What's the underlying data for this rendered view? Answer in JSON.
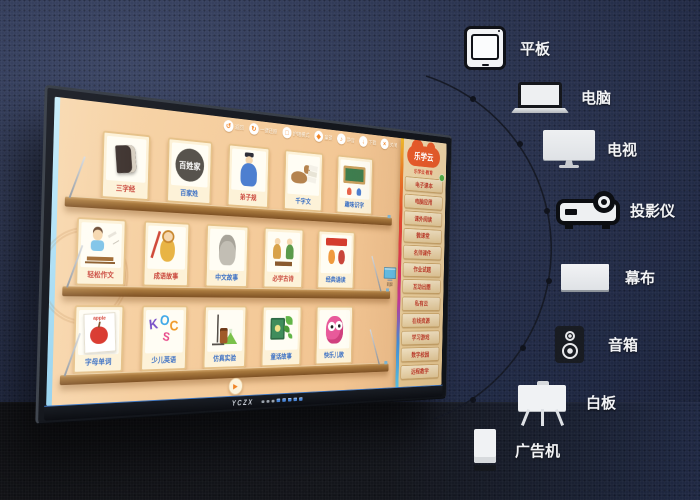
{
  "palette": {
    "background_navy": "#2b3450",
    "floor_dark": "#131419",
    "screen_peach": "#f5cd9f",
    "shelf_wood": "#9c6a33",
    "accent_orange": "#f08426",
    "logo_red": "#ee5a2a",
    "menu_text_red": "#c0392b",
    "device_label_white": "#f2f3f5"
  },
  "devices": [
    {
      "id": "tablet",
      "label": "平板"
    },
    {
      "id": "computer",
      "label": "电脑"
    },
    {
      "id": "tv",
      "label": "电视"
    },
    {
      "id": "projector",
      "label": "投影仪"
    },
    {
      "id": "projection-screen",
      "label": "幕布"
    },
    {
      "id": "speaker",
      "label": "音箱"
    },
    {
      "id": "whiteboard",
      "label": "白板"
    },
    {
      "id": "ad-kiosk",
      "label": "广告机"
    }
  ],
  "board": {
    "brand": "YCZX",
    "play_char": "▶",
    "seal_text": "百姓家",
    "letters": "KOCS",
    "apple_word": "apple",
    "mini_display_label": "同屏",
    "toolbar": [
      {
        "char": "↺",
        "label": "返回"
      },
      {
        "char": "↻",
        "label": "一键还原"
      },
      {
        "char": "□",
        "label": "护眼模式"
      },
      {
        "char": "◆",
        "label": "童锁"
      },
      {
        "char": "♪",
        "label": "静音"
      },
      {
        "char": "↓",
        "label": "下载"
      },
      {
        "char": "×",
        "label": "关闭"
      }
    ],
    "shelves": [
      {
        "cards": [
          {
            "label": "三字经",
            "label_style": "color:#c9453a"
          },
          {
            "label": "百家姓",
            "label_style": "color:#3a6fc4"
          },
          {
            "label": "弟子规",
            "label_style": "color:#c9453a"
          },
          {
            "label": "千字文",
            "label_style": "color:#3a6fc4"
          },
          {
            "label": "趣味识字",
            "label_style": "color:#3a6fc4"
          }
        ]
      },
      {
        "cards": [
          {
            "label": "轻松作文",
            "label_style": "color:#c9453a"
          },
          {
            "label": "成语故事",
            "label_style": "color:#c9453a"
          },
          {
            "label": "中文故事",
            "label_style": "color:#3a6fc4"
          },
          {
            "label": "必学古诗",
            "label_style": "color:#c9453a"
          },
          {
            "label": "经典诵读",
            "label_style": "color:#3a6fc4"
          }
        ]
      },
      {
        "cards": [
          {
            "label": "字母单词",
            "label_style": "color:#3a6fc4"
          },
          {
            "label": "少儿英语",
            "label_style": "color:#3a6fc4"
          },
          {
            "label": "仿真实验",
            "label_style": "color:#3a6fc4"
          },
          {
            "label": "童话故事",
            "label_style": "color:#3a6fc4"
          },
          {
            "label": "快乐儿歌",
            "label_style": "color:#3a6fc4"
          }
        ]
      }
    ],
    "sidebar": {
      "logo": "乐学云",
      "tagline": "乐学云·教育",
      "items": [
        "电子课本",
        "电脑应用",
        "课外阅读",
        "微课堂",
        "名师课件",
        "作业试题",
        "互动出题",
        "私有云",
        "在线资源",
        "学习游戏",
        "数字校园",
        "远程教学"
      ]
    }
  }
}
